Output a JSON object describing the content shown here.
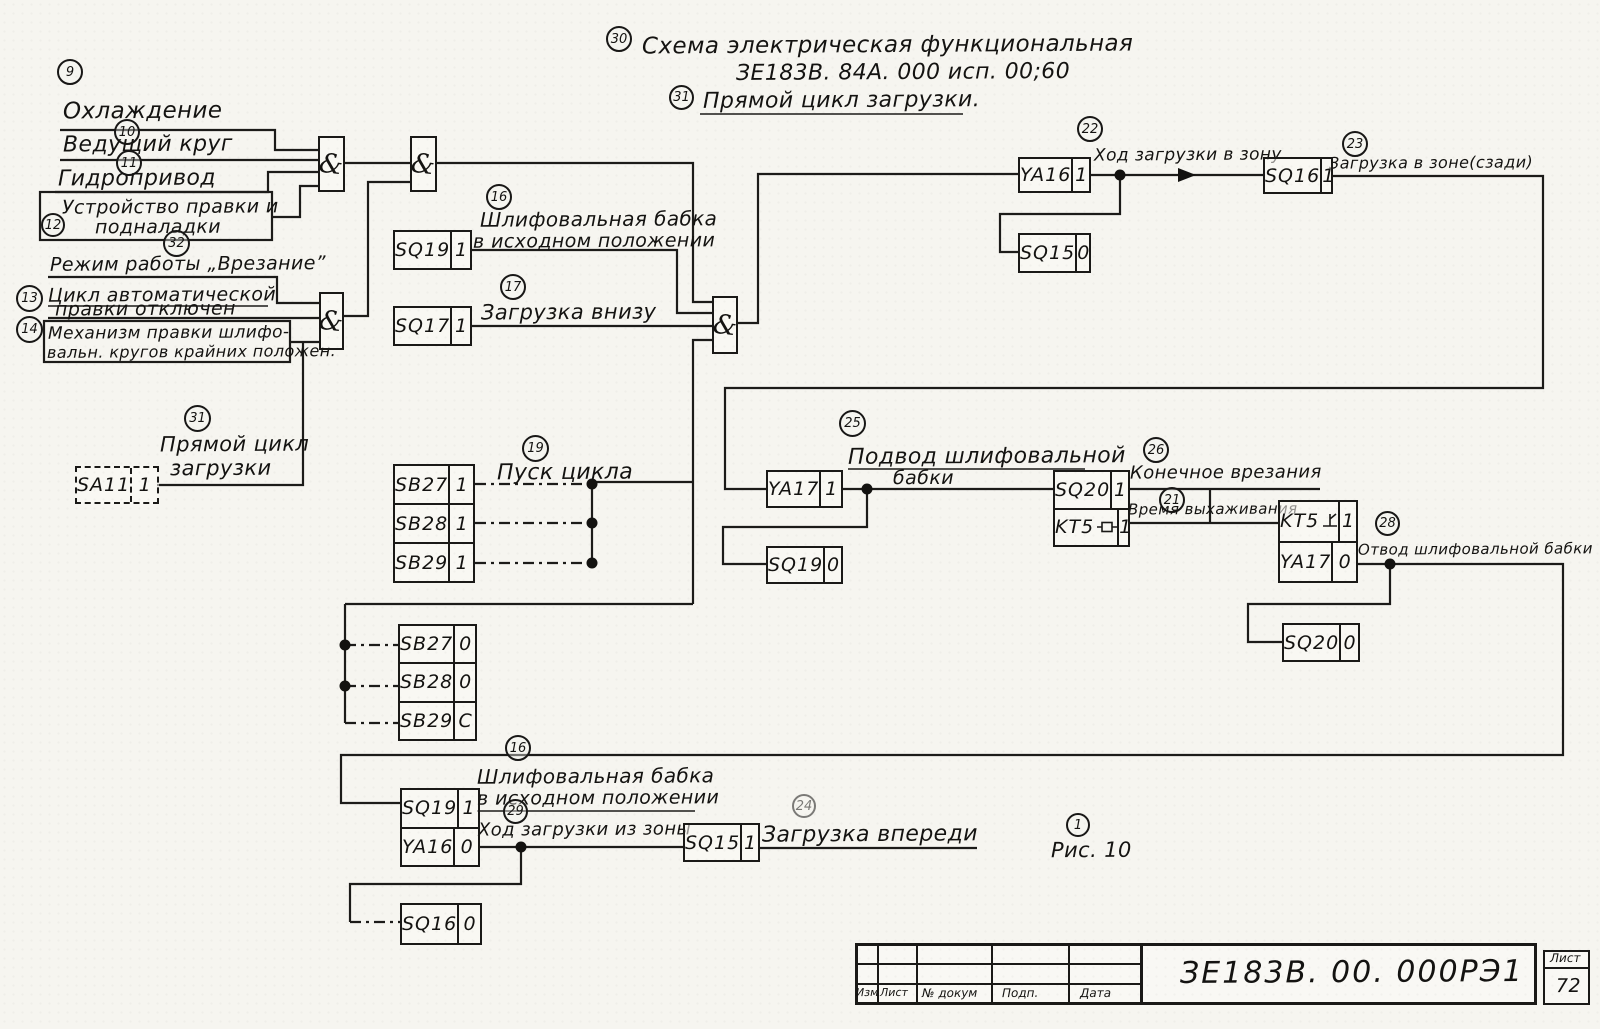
{
  "doc": {
    "callout30": "30",
    "title_line1": "Схема электрическая функциональная",
    "title_line2": "ЗЕ183В. 84А. 000 исп. 00;60",
    "callout31": "31",
    "title_line3": "Прямой цикл загрузки."
  },
  "ann": {
    "a9": {
      "num": "9",
      "text": "Охлаждение"
    },
    "a10": {
      "num": "10",
      "text": "Ведущий круг"
    },
    "a11": {
      "num": "11",
      "text": "Гидропривод"
    },
    "a12": {
      "num": "12",
      "line1": "Устройство правки и",
      "line2": "подналадки"
    },
    "a32": {
      "num": "32",
      "text": "Режим работы „Врезание”"
    },
    "a13": {
      "num": "13",
      "line1": "Цикл автоматической",
      "line2": "правки отключен"
    },
    "a14": {
      "num": "14",
      "line1": "Механизм правки шлифо-",
      "line2": "вальн. кругов крайних положен."
    },
    "a31": {
      "num": "31",
      "line1": "Прямой цикл",
      "line2": "загрузки"
    },
    "a16top": {
      "num": "16",
      "line1": "Шлифовальная бабка",
      "line2": "в исходном положении"
    },
    "a17": {
      "num": "17",
      "text": "Загрузка внизу"
    },
    "a19": {
      "num": "19",
      "text": "Пуск  цикла"
    },
    "a22": {
      "num": "22",
      "text": "Ход загрузки в зону"
    },
    "a23": {
      "num": "23",
      "text": "Загрузка в зоне(сзади)"
    },
    "a25": {
      "num": "25",
      "line1": "Подвод шлифовальной",
      "line2": "бабки"
    },
    "a26": {
      "num": "26",
      "text": "Конечное врезания"
    },
    "a21": {
      "num": "21",
      "text": "Время выхаживания"
    },
    "a28": {
      "num": "28",
      "text": "Отвод шлифовальной бабки"
    },
    "a16bot": {
      "num": "16",
      "line1": "Шлифовальная бабка",
      "line2": "в исходном положении"
    },
    "a29": {
      "num": "29",
      "text": "Ход загрузки из зоны"
    },
    "a24": {
      "num": "24",
      "text": "Загрузка впереди"
    },
    "fig": {
      "num": "1",
      "text": "Рис. 10"
    }
  },
  "gates": {
    "and": "&"
  },
  "blocks": {
    "sa11": {
      "label": "SA11",
      "value": "1"
    },
    "sq19top": {
      "label": "SQ19",
      "value": "1"
    },
    "sq17": {
      "label": "SQ17",
      "value": "1"
    },
    "ya16": {
      "label": "YA16",
      "value": "1"
    },
    "sq15r": {
      "label": "SQ15",
      "value": "0"
    },
    "sq16r": {
      "label": "SQ16",
      "value": "1"
    },
    "sb1": {
      "rows": [
        {
          "label": "SB27",
          "value": "1"
        },
        {
          "label": "SB28",
          "value": "1"
        },
        {
          "label": "SB29",
          "value": "1"
        }
      ]
    },
    "sb0": {
      "rows": [
        {
          "label": "SB27",
          "value": "0"
        },
        {
          "label": "SB28",
          "value": "0"
        },
        {
          "label": "SB29",
          "value": "C"
        }
      ]
    },
    "ya17": {
      "label": "YA17",
      "value": "1"
    },
    "sq19echo": {
      "label": "SQ19",
      "value": "0"
    },
    "sq20kt5": {
      "rows": [
        {
          "label": "SQ20",
          "value": "1"
        },
        {
          "label": "KT5",
          "value": "1"
        }
      ]
    },
    "kt5ya17": {
      "rows": [
        {
          "label": "KT5",
          "value": "1"
        },
        {
          "label": "YA17",
          "value": "0"
        }
      ]
    },
    "sq20_0": {
      "label": "SQ20",
      "value": "0"
    },
    "sq19ya16": {
      "rows": [
        {
          "label": "SQ19",
          "value": "1"
        },
        {
          "label": "YA16",
          "value": "0"
        }
      ]
    },
    "sq15b": {
      "label": "SQ15",
      "value": "1"
    },
    "sq16b": {
      "label": "SQ16",
      "value": "0"
    }
  },
  "titleblock": {
    "doc_number": "ЗЕ183В. 00. 000РЭ1",
    "col_izm": "Изм",
    "col_list": "Лист",
    "col_dokum": "№ докум",
    "col_podp": "Подп.",
    "col_data": "Дата",
    "sheet_label": "Лист",
    "sheet_number": "72"
  }
}
